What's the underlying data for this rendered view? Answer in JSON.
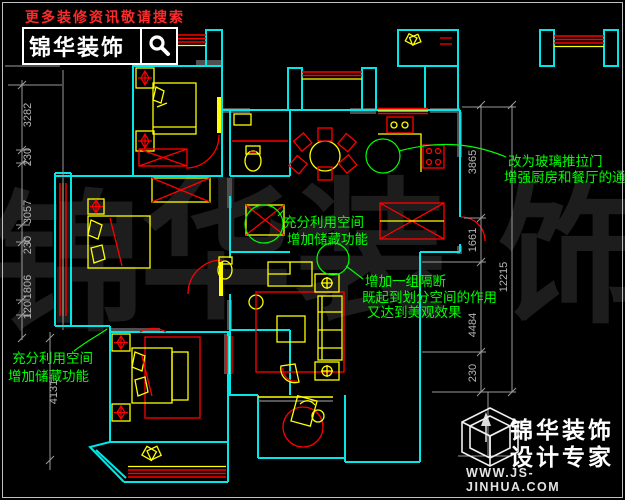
{
  "header": {
    "promo": "更多装修资讯敬请搜索",
    "brand": "锦华装饰",
    "search_icon": "magnifier"
  },
  "watermark": {
    "chars": [
      "锦",
      "华",
      "装",
      "饰"
    ]
  },
  "annotations": {
    "storage_top": {
      "lines": [
        "充分利用空间",
        "增加储藏功能"
      ]
    },
    "partition": {
      "lines": [
        "增加一组隔断",
        "既起到划分空间的作用",
        "又达到美观效果"
      ]
    },
    "glass_door": {
      "lines": [
        "改为玻璃推拉门",
        "增强厨房和餐厅的通"
      ]
    },
    "storage_bottom": {
      "lines": [
        "充分利用空间",
        "增加储藏功能"
      ]
    }
  },
  "dimensions": {
    "left": [
      "3282",
      "230",
      "3057",
      "230",
      "1806",
      "120"
    ],
    "left_lower": "4131",
    "right_inner": [
      "3865",
      "1661",
      "4484",
      "230"
    ],
    "right_outer": "12215"
  },
  "footer": {
    "brand": "锦华装饰",
    "tagline": "设计专家",
    "url": "WWW.JS-JINHUA.COM"
  },
  "colors": {
    "wall": "#00e8e8",
    "furniture": "#ffff00",
    "accent": "#ff0000",
    "annotation": "#00ff00",
    "dimension": "#9a9a9a",
    "promo": "#ff2a2a",
    "watermark": "#1d1d1d",
    "background": "#000000"
  }
}
